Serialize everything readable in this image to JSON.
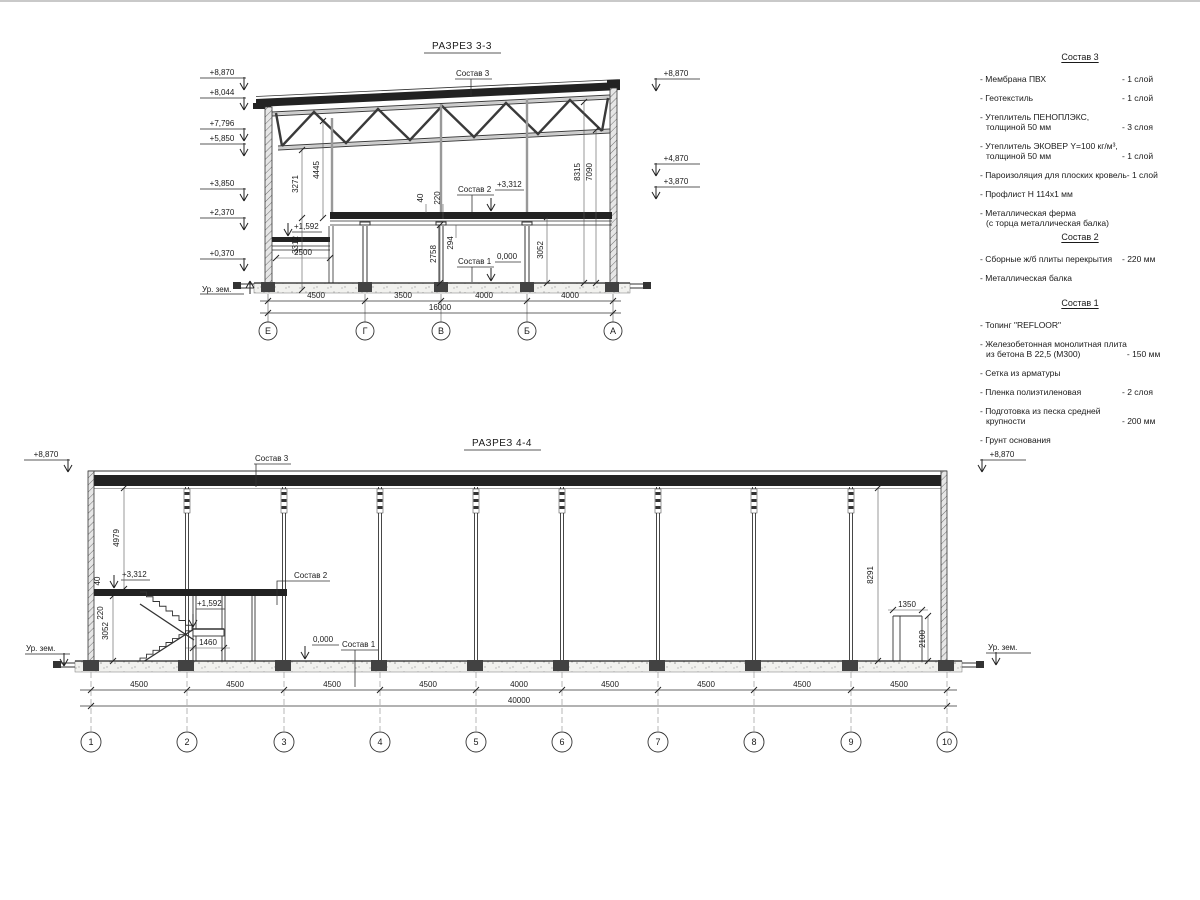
{
  "s33": {
    "title": "РАЗРЕЗ 3-3",
    "elev_left": [
      "+8,870",
      "+8,044",
      "+7,796",
      "+5,850",
      "+3,850",
      "+2,370",
      "+0,370"
    ],
    "ground_left": "Ур. зем.",
    "elev_right": [
      "+8,870",
      "+4,870",
      "+3,870"
    ],
    "labels": {
      "sostav3": "Состав 3",
      "sostav2": "Состав 2",
      "sostav1": "Состав 1",
      "lvl_3312": "+3,312",
      "lvl_0000": "0,000",
      "lvl_1592": "+1,592"
    },
    "dims_vertical": [
      "3271",
      "4445",
      "3312",
      "40",
      "220",
      "294",
      "2758",
      "3052",
      "8315",
      "7090"
    ],
    "dim_2500": "2500",
    "dims_bottom": [
      "4500",
      "3500",
      "4000",
      "4000"
    ],
    "dim_total": "16000",
    "axes": [
      "Е",
      "Г",
      "В",
      "Б",
      "А"
    ]
  },
  "s44": {
    "title": "РАЗРЕЗ 4-4",
    "elev_left": "+8,870",
    "elev_right": "+8,870",
    "ground_left": "Ур. зем.",
    "ground_right": "Ур. зем.",
    "labels": {
      "sostav3": "Состав 3",
      "sostav2": "Состав 2",
      "sostav1": "Состав 1",
      "lvl_3312": "+3,312",
      "lvl_1592": "+1,592",
      "lvl_0000": "0,000"
    },
    "dims_vertical": [
      "4979",
      "40",
      "220",
      "3052",
      "8291",
      "2100"
    ],
    "dim_1460": "1460",
    "dim_1350": "1350",
    "dims_bottom": [
      "4500",
      "4500",
      "4500",
      "4500",
      "4000",
      "4500",
      "4500",
      "4500",
      "4500"
    ],
    "dim_total": "40000",
    "axes": [
      "1",
      "2",
      "3",
      "4",
      "5",
      "6",
      "7",
      "8",
      "9",
      "10"
    ]
  },
  "legend": {
    "comp3": {
      "heading": "Состав 3",
      "items": [
        {
          "n1": "- Мембрана ПВХ",
          "n2": "",
          "q": "- 1 слой"
        },
        {
          "n1": "- Геотекстиль",
          "n2": "",
          "q": "- 1 слой"
        },
        {
          "n1": "- Утеплитель ПЕНОПЛЭКС,",
          "n2": "толщиной 50 мм",
          "q": "- 3 слоя"
        },
        {
          "n1": "- Утеплитель ЭКОВЕР Y=100 кг/м³,",
          "n2": "толщиной 50 мм",
          "q": "- 1 слой"
        },
        {
          "n1": "- Пароизоляция для плоских кровель",
          "n2": "",
          "q": "- 1 слой"
        },
        {
          "n1": "- Профлист Н 114х1 мм",
          "n2": "",
          "q": ""
        },
        {
          "n1": "- Металлическая ферма",
          "n2": "(с торца металлическая балка)",
          "q": ""
        }
      ]
    },
    "comp2": {
      "heading": "Состав 2",
      "items": [
        {
          "n1": "- Сборные ж/б плиты перекрытия",
          "n2": "",
          "q": "- 220 мм"
        },
        {
          "n1": "- Металлическая балка",
          "n2": "",
          "q": ""
        }
      ]
    },
    "comp1": {
      "heading": "Состав 1",
      "items": [
        {
          "n1": "- Топинг \"REFLOOR\"",
          "n2": "",
          "q": ""
        },
        {
          "n1": "- Железобетонная монолитная плита",
          "n2": "из бетона В 22,5 (М300)",
          "q": "- 150 мм"
        },
        {
          "n1": "- Сетка из арматуры",
          "n2": "",
          "q": ""
        },
        {
          "n1": "- Пленка полиэтиленовая",
          "n2": "",
          "q": "- 2 слоя"
        },
        {
          "n1": "- Подготовка из песка средней",
          "n2": "крупности",
          "q": "- 200 мм"
        },
        {
          "n1": "- Грунт основания",
          "n2": "",
          "q": ""
        }
      ]
    }
  }
}
